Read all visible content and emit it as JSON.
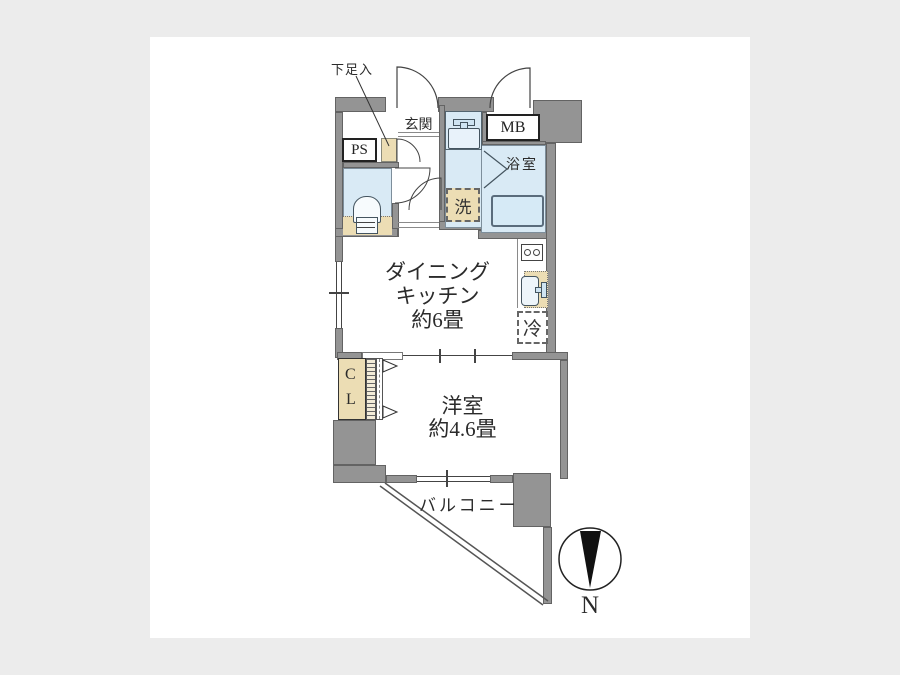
{
  "colors": {
    "wall_gray": "#949494",
    "wet_blue": "#d9eaf5",
    "wood_beige": "#ecddb4",
    "frame_bg": "#ececec",
    "ink": "#2b2b2b"
  },
  "labels": {
    "shoe_cabinet": "下足入",
    "entrance": "玄関",
    "pipe_space": "PS",
    "meter_box": "MB",
    "bathroom": "浴室",
    "laundry": "洗",
    "dining_kitchen": {
      "l1": "ダイニング",
      "l2": "キッチン",
      "l3": "約6畳"
    },
    "refrigerator": "冷",
    "closet": {
      "l1": "C",
      "l2": "L"
    },
    "bedroom": {
      "l1": "洋室",
      "l2": "約4.6畳"
    },
    "balcony": "バルコニー",
    "compass_north": "N"
  }
}
